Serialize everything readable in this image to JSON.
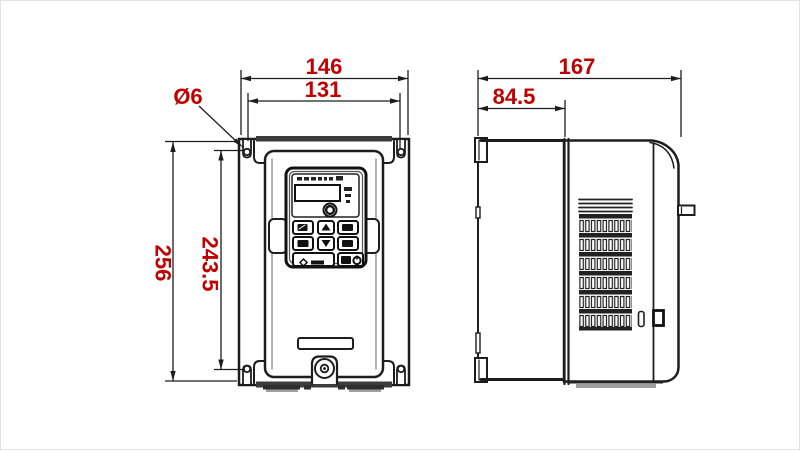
{
  "dimensions": {
    "front_overall_width": "146",
    "front_hole_spacing_width": "131",
    "front_hole_diameter": "Ø6",
    "front_overall_height": "256",
    "front_hole_spacing_height": "243.5",
    "side_overall_depth": "167",
    "side_mount_depth": "84.5"
  },
  "colors": {
    "dimension_text": "#c00000",
    "outline": "#1d1d1d",
    "fill": "#ffffff",
    "shadow": "#9d9d9d"
  },
  "icons": {
    "keypad": [
      "prg-key-icon",
      "up-arrow-icon",
      "shift-key-icon",
      "esc-key-icon",
      "down-arrow-icon",
      "enter-key-icon",
      "run-key-icon",
      "stop-key-icon",
      "potentiometer-knob"
    ]
  }
}
